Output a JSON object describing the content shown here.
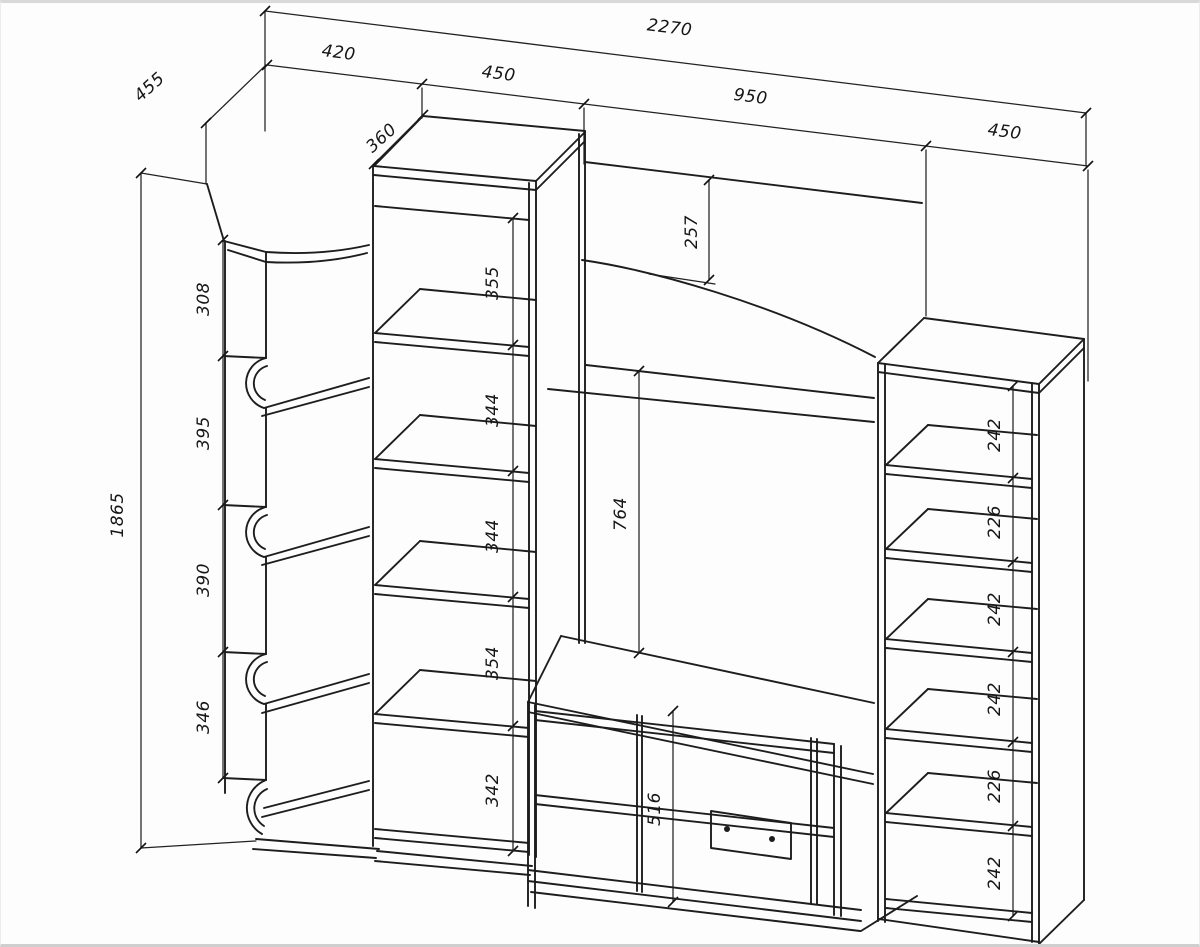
{
  "drawing": {
    "type": "furniture-dimension-diagram",
    "line_color": "#1d1d1d",
    "paper_color": "#fdfdfd",
    "dims": {
      "total_width": "2270",
      "left_depth": "455",
      "left_width": "420",
      "tower_width": "450",
      "center_width": "950",
      "right_width": "450",
      "tower_depth": "360",
      "total_height": "1865",
      "arch_drop": "257",
      "niche_height": "764",
      "stand_height": "516",
      "left_sections": [
        "308",
        "395",
        "390",
        "346"
      ],
      "tower_sections": [
        "355",
        "344",
        "344",
        "354",
        "342"
      ],
      "right_sections": [
        "242",
        "226",
        "242",
        "242",
        "226",
        "242"
      ]
    }
  }
}
